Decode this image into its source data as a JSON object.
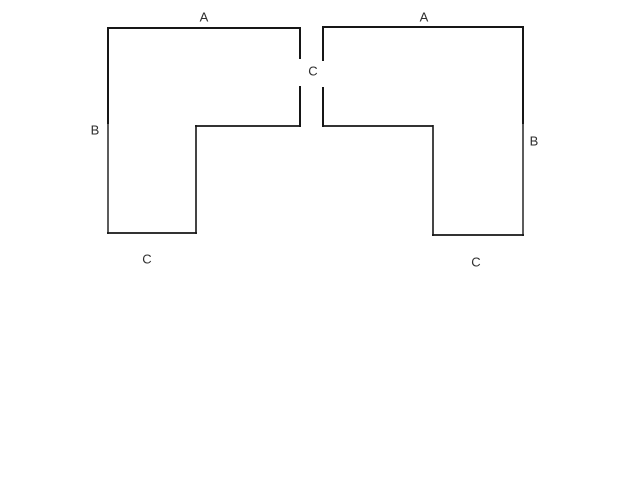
{
  "canvas": {
    "width": 640,
    "height": 480,
    "background_color": "#ffffff"
  },
  "diagram": {
    "stroke_color": "#161616",
    "default_stroke_width": 2,
    "label_color": "#2e2e2e",
    "label_font_size": 13,
    "shapes": [
      {
        "id": "left-l-shape",
        "segments": [
          {
            "name": "top-edge",
            "x1": 107,
            "y1": 28,
            "x2": 301,
            "y2": 28
          },
          {
            "name": "right-edge-upper",
            "x1": 300,
            "y1": 27,
            "x2": 300,
            "y2": 59
          },
          {
            "name": "right-edge-lower",
            "x1": 300,
            "y1": 86,
            "x2": 300,
            "y2": 127
          },
          {
            "name": "notch-edge",
            "x1": 301,
            "y1": 126,
            "x2": 195,
            "y2": 126,
            "w": 1.8
          },
          {
            "name": "inner-vertical",
            "x1": 196,
            "y1": 125,
            "x2": 196,
            "y2": 234,
            "w": 1.6
          },
          {
            "name": "bottom-edge",
            "x1": 197,
            "y1": 233,
            "x2": 107,
            "y2": 233,
            "w": 1.8
          },
          {
            "name": "left-edge-upper",
            "x1": 108,
            "y1": 27,
            "x2": 108,
            "y2": 124
          },
          {
            "name": "left-edge-lower",
            "x1": 108,
            "y1": 124,
            "x2": 108,
            "y2": 234,
            "w": 1.4
          }
        ]
      },
      {
        "id": "right-l-shape",
        "segments": [
          {
            "name": "top-edge",
            "x1": 322,
            "y1": 27,
            "x2": 524,
            "y2": 27
          },
          {
            "name": "left-edge-upper",
            "x1": 323,
            "y1": 26,
            "x2": 323,
            "y2": 61
          },
          {
            "name": "left-edge-lower",
            "x1": 323,
            "y1": 87,
            "x2": 323,
            "y2": 127
          },
          {
            "name": "notch-edge",
            "x1": 322,
            "y1": 126,
            "x2": 433,
            "y2": 126,
            "w": 1.8
          },
          {
            "name": "inner-vertical",
            "x1": 433,
            "y1": 125,
            "x2": 433,
            "y2": 236,
            "w": 1.6
          },
          {
            "name": "bottom-edge",
            "x1": 432,
            "y1": 235,
            "x2": 524,
            "y2": 235,
            "w": 1.8
          },
          {
            "name": "right-edge-upper",
            "x1": 523,
            "y1": 26,
            "x2": 523,
            "y2": 124
          },
          {
            "name": "right-edge-lower",
            "x1": 523,
            "y1": 124,
            "x2": 523,
            "y2": 236,
            "w": 1.4
          }
        ]
      }
    ],
    "labels": [
      {
        "id": "a-left",
        "text": "A",
        "x": 204,
        "y": 17
      },
      {
        "id": "a-right",
        "text": "A",
        "x": 424,
        "y": 17
      },
      {
        "id": "c-center-gap",
        "text": "C",
        "x": 313,
        "y": 71
      },
      {
        "id": "b-left",
        "text": "B",
        "x": 95,
        "y": 130
      },
      {
        "id": "b-right",
        "text": "B",
        "x": 534,
        "y": 141
      },
      {
        "id": "c-left-bottom",
        "text": "C",
        "x": 147,
        "y": 259
      },
      {
        "id": "c-right-bottom",
        "text": "C",
        "x": 476,
        "y": 262
      }
    ]
  }
}
